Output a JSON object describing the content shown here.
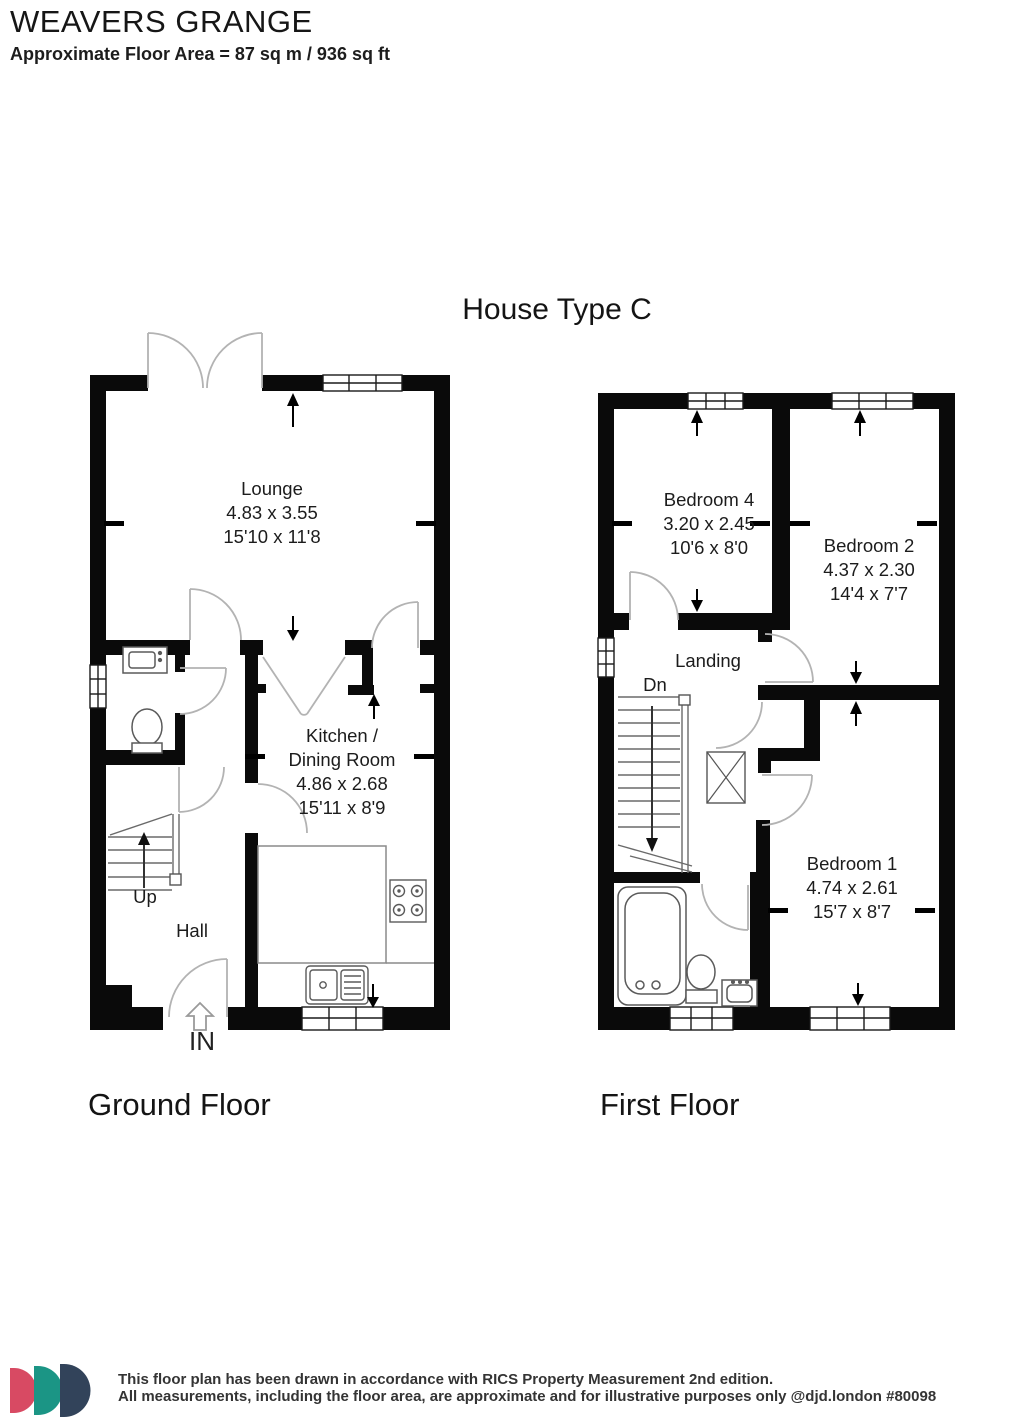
{
  "header": {
    "title": "WEAVERS GRANGE",
    "subtitle": "Approximate Floor Area = 87 sq m / 936 sq ft"
  },
  "plan": {
    "house_type": "House Type C",
    "ground_floor": {
      "label": "Ground Floor",
      "rooms": {
        "lounge": {
          "name": "Lounge",
          "metric": "4.83 x 3.55",
          "imperial": "15'10 x 11'8"
        },
        "kitchen": {
          "name_line1": "Kitchen  /",
          "name_line2": "Dining Room",
          "metric": "4.86 x 2.68",
          "imperial": "15'11 x 8'9"
        },
        "hall": {
          "name": "Hall"
        }
      },
      "annotations": {
        "up": "Up",
        "in": "IN"
      }
    },
    "first_floor": {
      "label": "First Floor",
      "rooms": {
        "bedroom4": {
          "name": "Bedroom 4",
          "metric": "3.20 x 2.45",
          "imperial": "10'6 x 8'0"
        },
        "bedroom2": {
          "name": "Bedroom 2",
          "metric": "4.37 x 2.30",
          "imperial": "14'4 x 7'7"
        },
        "bedroom1": {
          "name": "Bedroom 1",
          "metric": "4.74 x 2.61",
          "imperial": "15'7 x 8'7"
        },
        "landing": {
          "name": "Landing"
        }
      },
      "annotations": {
        "dn": "Dn"
      }
    }
  },
  "footer": {
    "line1": "This floor plan has been drawn in accordance with RICS Property Measurement 2nd edition.",
    "line2": "All measurements, including the floor area, are approximate and for illustrative purposes only @djd.london #80098",
    "logo_colors": {
      "pink": "#d84a63",
      "teal": "#1b9585",
      "slate": "#32435a"
    }
  }
}
